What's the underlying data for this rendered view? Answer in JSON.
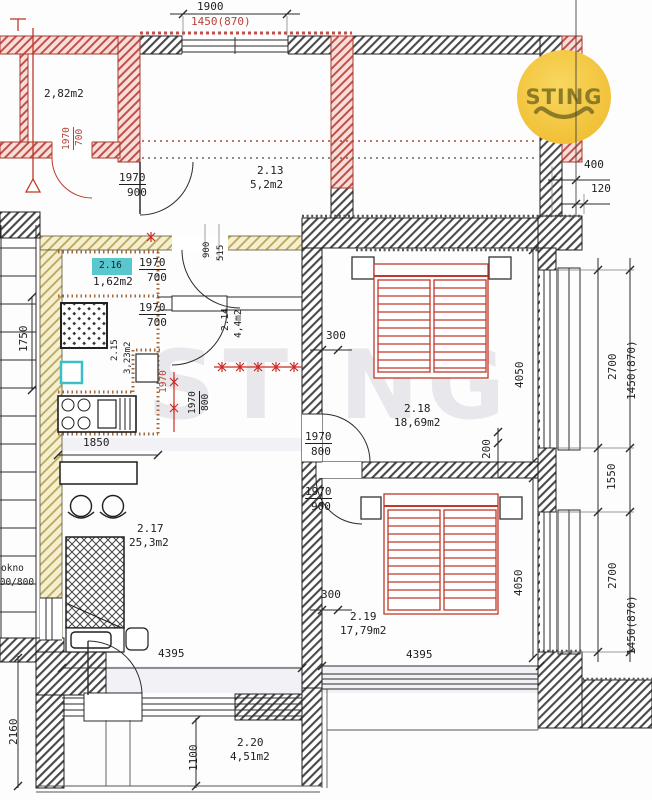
{
  "logo": {
    "text": "STING",
    "circle_color": "#f4c63b",
    "text_color": "#8e7b26"
  },
  "watermark": {
    "text": "STING"
  },
  "rooms": {
    "r_top_left": {
      "area": "2,82m2"
    },
    "r213": {
      "id": "2.13",
      "area": "5,2m2"
    },
    "r214": {
      "id": "2.14",
      "area": "4,4m2"
    },
    "r215": {
      "id": "2.15",
      "area": "3,23m2"
    },
    "r216": {
      "id": "2.16",
      "area": "1,62m2",
      "highlight": "#59c8ce"
    },
    "r217": {
      "id": "2.17",
      "area": "25,3m2"
    },
    "r218": {
      "id": "2.18",
      "area": "18,69m2"
    },
    "r219": {
      "id": "2.19",
      "area": "17,79m2"
    },
    "r220": {
      "id": "2.20",
      "area": "4,51m2"
    }
  },
  "doors": {
    "red_top": {
      "h": "1970",
      "w": "700"
    },
    "top_900": {
      "h": "1970",
      "w": "900"
    },
    "hall_a": {
      "h": "1970",
      "w": "700"
    },
    "hall_b": {
      "h": "1970",
      "w": "700"
    },
    "hall_v": {
      "h": "1970",
      "w": "800"
    },
    "hall_v_red": "1970",
    "bed218": {
      "h": "1970",
      "w": "800"
    },
    "bed219": {
      "h": "1970",
      "w": "900"
    }
  },
  "dims": {
    "top_width": "1900",
    "top_window": "1450(870)",
    "off_400": "400",
    "off_120": "120",
    "win1_h": "2700",
    "win1_w": "1450(870)",
    "pier": "1550",
    "win2_h": "2700",
    "win2_w": "1450(870)",
    "room218_depth": "4050",
    "room219_depth": "4050",
    "offset_200": "200",
    "offset_300a": "300",
    "offset_300b": "300",
    "room217_width": "4395",
    "room219_width": "4395",
    "kitchen_width": "1850",
    "stair_run": "1750",
    "niche_900": "900",
    "niche_515": "515",
    "balcony_height": "2160",
    "balcony_depth": "1100"
  },
  "annotations": {
    "window_label": "okno",
    "window_size": "700/800"
  }
}
